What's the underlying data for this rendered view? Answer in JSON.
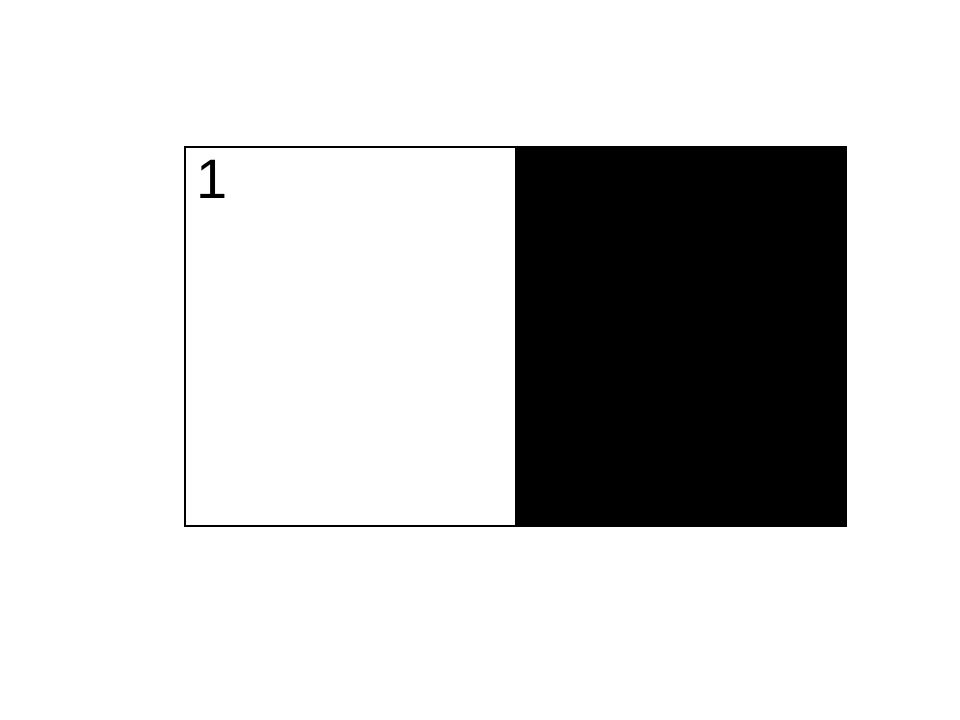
{
  "figure": {
    "label": "1",
    "colors": {
      "background": "#ffffff",
      "left_panel": "#ffffff",
      "right_panel": "#000000",
      "border": "#000000",
      "label_text": "#000000"
    }
  }
}
